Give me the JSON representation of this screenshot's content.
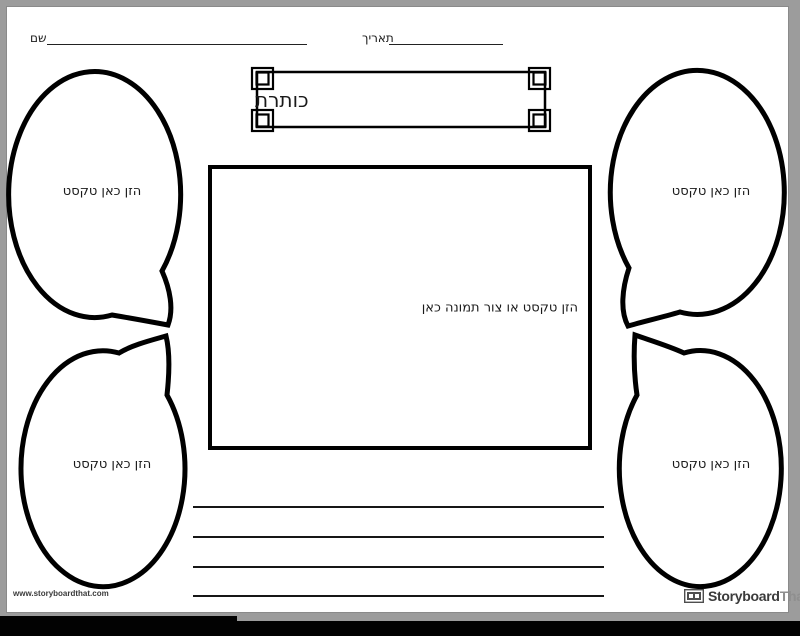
{
  "header": {
    "name_label": "שם",
    "date_label": "תאריך"
  },
  "title_banner": {
    "text": "כותרת"
  },
  "image_box": {
    "placeholder": "הזן טקסט או צור תמונה כאן"
  },
  "bubbles": [
    {
      "position": "top-left",
      "text": "הזן כאן טקסט"
    },
    {
      "position": "bottom-left",
      "text": "הזן כאן טקסט"
    },
    {
      "position": "top-right",
      "text": "הזן כאן טקסט"
    },
    {
      "position": "bottom-right",
      "text": "הזן כאן טקסט"
    }
  ],
  "footer": {
    "url": "www.storyboardthat.com",
    "brand_primary": "Storyboard",
    "brand_secondary": "That"
  },
  "colors": {
    "page_bg": "#ffffff",
    "margin_gray": "#9c9c9c",
    "ink": "#000000",
    "brand_dark": "#3b3b3b",
    "brand_light": "#8f8f8f",
    "taskbar": "#020202"
  }
}
